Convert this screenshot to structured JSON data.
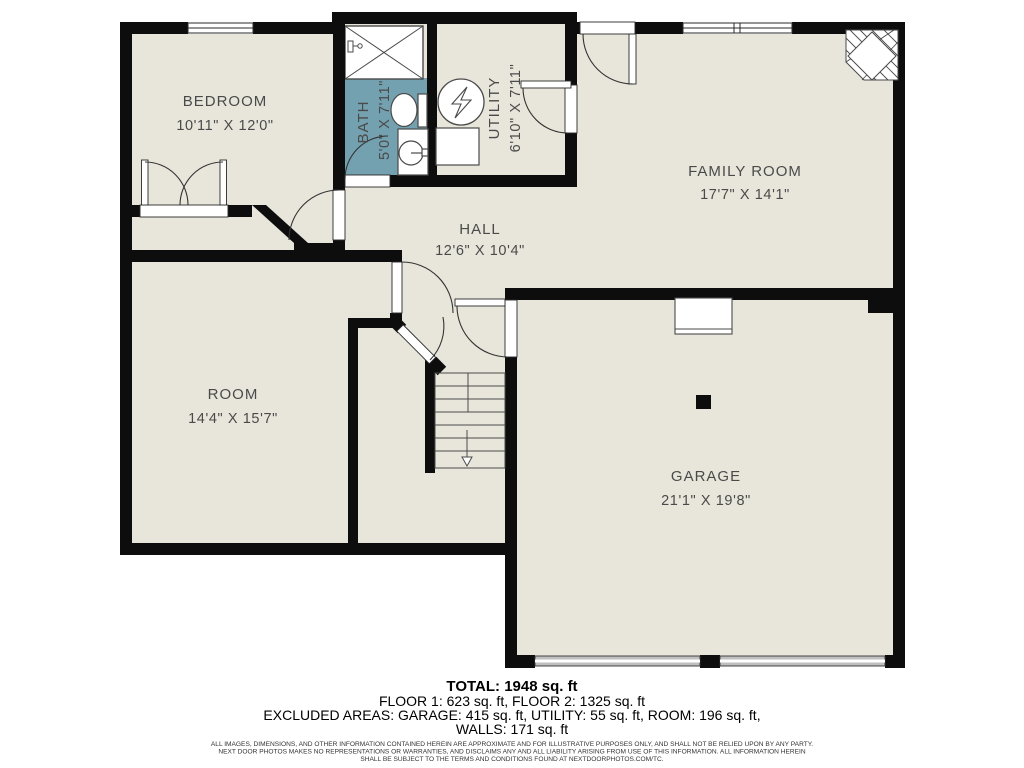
{
  "colors": {
    "floor": "#e8e6db",
    "wall": "#0d0d0d",
    "bath_floor": "#74a1af",
    "fixture_line": "#4a4a4a",
    "label_text": "#4a4a4a",
    "garage_door_gray": "#bfbfbf"
  },
  "rooms": {
    "bedroom": {
      "label": "BEDROOM",
      "dims": "10'11\" X 12'0\""
    },
    "bath": {
      "label": "BATH",
      "dims": "5'0\" X 7'11\""
    },
    "utility": {
      "label": "UTILITY",
      "dims": "6'10\" X 7'11\""
    },
    "family": {
      "label": "FAMILY ROOM",
      "dims": "17'7\" X 14'1\""
    },
    "hall": {
      "label": "HALL",
      "dims": "12'6\" X 10'4\""
    },
    "room": {
      "label": "ROOM",
      "dims": "14'4\" X 15'7\""
    },
    "garage": {
      "label": "GARAGE",
      "dims": "21'1\" X 19'8\""
    }
  },
  "summary": {
    "total": "TOTAL: 1948 sq. ft",
    "floors": "FLOOR 1: 623 sq. ft, FLOOR 2: 1325 sq. ft",
    "excluded": "EXCLUDED AREAS: GARAGE: 415 sq. ft, UTILITY: 55 sq. ft, ROOM: 196 sq. ft,",
    "walls": "WALLS: 171 sq. ft"
  },
  "disclaimer": {
    "line1": "ALL IMAGES, DIMENSIONS, AND OTHER INFORMATION CONTAINED HEREIN ARE APPROXIMATE AND FOR ILLUSTRATIVE PURPOSES ONLY, AND SHALL NOT BE RELIED UPON BY ANY PARTY.",
    "line2": "NEXT DOOR PHOTOS MAKES NO REPRESENTATIONS OR WARRANTIES, AND DISCLAIMS ANY AND ALL LIABILITY ARISING FROM USE OF THIS INFORMATION. ALL INFORMATION HEREIN",
    "line3": "SHALL BE SUBJECT TO THE TERMS AND CONDITIONS FOUND AT NEXTDOORPHOTOS.COM/TC."
  }
}
